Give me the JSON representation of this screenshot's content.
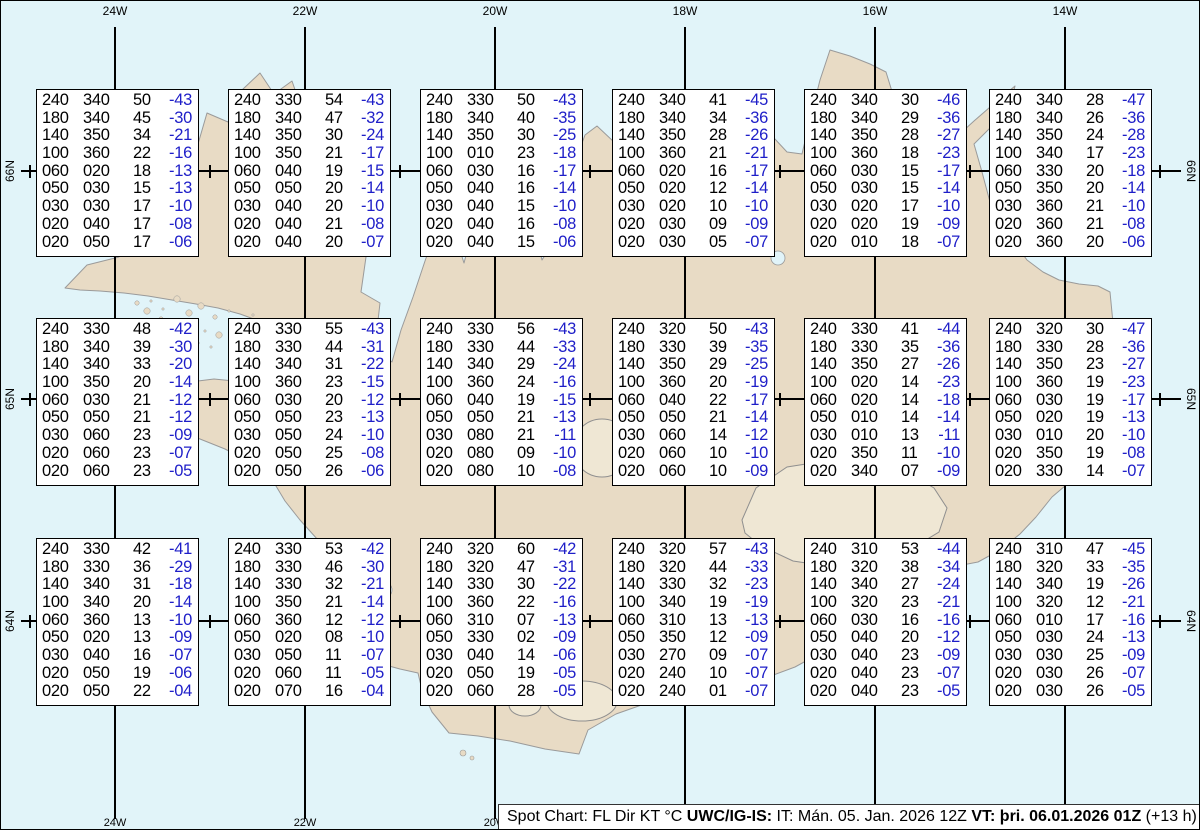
{
  "colors": {
    "sea": "#e1f4f9",
    "land": "#e8dbc5",
    "glacier": "#efe7d4",
    "coast": "#9a9a9a",
    "grid": "#000000",
    "box_bg": "#ffffff",
    "box_border": "#000000",
    "temp_blue": "#1e1ec8"
  },
  "map": {
    "meridian_labels_top": [
      "24W",
      "22W",
      "20W",
      "18W",
      "16W",
      "14W"
    ],
    "meridian_labels_bottom": [
      "24W",
      "22W",
      "20W"
    ],
    "parallel_labels_left": [
      "66N",
      "65N",
      "64N"
    ],
    "parallel_labels_right": [
      "66N",
      "65N",
      "64N"
    ]
  },
  "info_bar": {
    "segments": [
      {
        "text": "Spot Chart: FL Dir KT °C ",
        "bold": false
      },
      {
        "text": "UWC/IG-IS:",
        "bold": true
      },
      {
        "text": " IT: Mán. 05. Jan. 2026 12Z ",
        "bold": false
      },
      {
        "text": "VT: þri. 06.01.2026 01Z",
        "bold": true
      },
      {
        "text": " (+13 h)",
        "bold": false
      }
    ]
  },
  "chart_data": {
    "type": "table",
    "title": "Spot Chart: FL Dir KT °C",
    "issued_label": "IT: Mán. 05. Jan. 2026 12Z",
    "valid_label": "VT: þri. 06.01.2026 01Z (+13 h)",
    "columns": [
      "FL",
      "Dir",
      "KT",
      "°C"
    ],
    "grid_meridians": [
      "24W",
      "22W",
      "20W",
      "18W",
      "16W",
      "14W"
    ],
    "grid_parallels": [
      "66N",
      "65N",
      "64N"
    ],
    "spots": [
      {
        "rows": [
          [
            "240",
            "340",
            "50",
            "-43"
          ],
          [
            "180",
            "340",
            "45",
            "-30"
          ],
          [
            "140",
            "350",
            "34",
            "-21"
          ],
          [
            "100",
            "360",
            "22",
            "-16"
          ],
          [
            "060",
            "020",
            "18",
            "-13"
          ],
          [
            "050",
            "030",
            "15",
            "-13"
          ],
          [
            "030",
            "030",
            "17",
            "-10"
          ],
          [
            "020",
            "040",
            "17",
            "-08"
          ],
          [
            "020",
            "050",
            "17",
            "-06"
          ]
        ]
      },
      {
        "rows": [
          [
            "240",
            "330",
            "54",
            "-43"
          ],
          [
            "180",
            "340",
            "47",
            "-32"
          ],
          [
            "140",
            "350",
            "30",
            "-24"
          ],
          [
            "100",
            "350",
            "21",
            "-17"
          ],
          [
            "060",
            "040",
            "19",
            "-15"
          ],
          [
            "050",
            "050",
            "20",
            "-14"
          ],
          [
            "030",
            "040",
            "20",
            "-10"
          ],
          [
            "020",
            "040",
            "21",
            "-08"
          ],
          [
            "020",
            "040",
            "20",
            "-07"
          ]
        ]
      },
      {
        "rows": [
          [
            "240",
            "330",
            "50",
            "-43"
          ],
          [
            "180",
            "340",
            "40",
            "-35"
          ],
          [
            "140",
            "350",
            "30",
            "-25"
          ],
          [
            "100",
            "010",
            "23",
            "-18"
          ],
          [
            "060",
            "030",
            "16",
            "-17"
          ],
          [
            "050",
            "040",
            "16",
            "-14"
          ],
          [
            "030",
            "040",
            "15",
            "-10"
          ],
          [
            "020",
            "040",
            "16",
            "-08"
          ],
          [
            "020",
            "040",
            "15",
            "-06"
          ]
        ]
      },
      {
        "rows": [
          [
            "240",
            "340",
            "41",
            "-45"
          ],
          [
            "180",
            "340",
            "34",
            "-36"
          ],
          [
            "140",
            "350",
            "28",
            "-26"
          ],
          [
            "100",
            "360",
            "21",
            "-21"
          ],
          [
            "060",
            "020",
            "16",
            "-17"
          ],
          [
            "050",
            "020",
            "12",
            "-14"
          ],
          [
            "030",
            "020",
            "10",
            "-10"
          ],
          [
            "020",
            "030",
            "09",
            "-09"
          ],
          [
            "020",
            "030",
            "05",
            "-07"
          ]
        ]
      },
      {
        "rows": [
          [
            "240",
            "340",
            "30",
            "-46"
          ],
          [
            "180",
            "340",
            "29",
            "-36"
          ],
          [
            "140",
            "350",
            "28",
            "-27"
          ],
          [
            "100",
            "360",
            "18",
            "-23"
          ],
          [
            "060",
            "030",
            "15",
            "-17"
          ],
          [
            "050",
            "030",
            "15",
            "-14"
          ],
          [
            "030",
            "020",
            "17",
            "-10"
          ],
          [
            "020",
            "020",
            "19",
            "-09"
          ],
          [
            "020",
            "010",
            "18",
            "-07"
          ]
        ]
      },
      {
        "rows": [
          [
            "240",
            "340",
            "28",
            "-47"
          ],
          [
            "180",
            "340",
            "26",
            "-36"
          ],
          [
            "140",
            "350",
            "24",
            "-28"
          ],
          [
            "100",
            "340",
            "17",
            "-23"
          ],
          [
            "060",
            "330",
            "20",
            "-18"
          ],
          [
            "050",
            "350",
            "20",
            "-14"
          ],
          [
            "030",
            "360",
            "21",
            "-10"
          ],
          [
            "020",
            "360",
            "21",
            "-08"
          ],
          [
            "020",
            "360",
            "20",
            "-06"
          ]
        ]
      },
      {
        "rows": [
          [
            "240",
            "330",
            "48",
            "-42"
          ],
          [
            "180",
            "340",
            "39",
            "-30"
          ],
          [
            "140",
            "340",
            "33",
            "-20"
          ],
          [
            "100",
            "350",
            "20",
            "-14"
          ],
          [
            "060",
            "030",
            "21",
            "-12"
          ],
          [
            "050",
            "050",
            "21",
            "-12"
          ],
          [
            "030",
            "060",
            "23",
            "-09"
          ],
          [
            "020",
            "060",
            "23",
            "-07"
          ],
          [
            "020",
            "060",
            "23",
            "-05"
          ]
        ]
      },
      {
        "rows": [
          [
            "240",
            "330",
            "55",
            "-43"
          ],
          [
            "180",
            "330",
            "44",
            "-31"
          ],
          [
            "140",
            "340",
            "31",
            "-22"
          ],
          [
            "100",
            "360",
            "23",
            "-15"
          ],
          [
            "060",
            "030",
            "20",
            "-12"
          ],
          [
            "050",
            "050",
            "23",
            "-13"
          ],
          [
            "030",
            "050",
            "24",
            "-10"
          ],
          [
            "020",
            "050",
            "25",
            "-08"
          ],
          [
            "020",
            "050",
            "26",
            "-06"
          ]
        ]
      },
      {
        "rows": [
          [
            "240",
            "330",
            "56",
            "-43"
          ],
          [
            "180",
            "330",
            "44",
            "-33"
          ],
          [
            "140",
            "340",
            "29",
            "-24"
          ],
          [
            "100",
            "360",
            "24",
            "-16"
          ],
          [
            "060",
            "040",
            "19",
            "-15"
          ],
          [
            "050",
            "050",
            "21",
            "-13"
          ],
          [
            "030",
            "080",
            "21",
            "-11"
          ],
          [
            "020",
            "080",
            "09",
            "-10"
          ],
          [
            "020",
            "080",
            "10",
            "-08"
          ]
        ]
      },
      {
        "rows": [
          [
            "240",
            "320",
            "50",
            "-43"
          ],
          [
            "180",
            "330",
            "39",
            "-35"
          ],
          [
            "140",
            "350",
            "29",
            "-25"
          ],
          [
            "100",
            "360",
            "20",
            "-19"
          ],
          [
            "060",
            "040",
            "22",
            "-17"
          ],
          [
            "050",
            "050",
            "21",
            "-14"
          ],
          [
            "030",
            "060",
            "14",
            "-12"
          ],
          [
            "020",
            "060",
            "10",
            "-10"
          ],
          [
            "020",
            "060",
            "10",
            "-09"
          ]
        ]
      },
      {
        "rows": [
          [
            "240",
            "330",
            "41",
            "-44"
          ],
          [
            "180",
            "330",
            "35",
            "-36"
          ],
          [
            "140",
            "350",
            "27",
            "-26"
          ],
          [
            "100",
            "020",
            "14",
            "-23"
          ],
          [
            "060",
            "020",
            "14",
            "-18"
          ],
          [
            "050",
            "010",
            "14",
            "-14"
          ],
          [
            "030",
            "010",
            "13",
            "-11"
          ],
          [
            "020",
            "350",
            "11",
            "-10"
          ],
          [
            "020",
            "340",
            "07",
            "-09"
          ]
        ]
      },
      {
        "rows": [
          [
            "240",
            "320",
            "30",
            "-47"
          ],
          [
            "180",
            "330",
            "28",
            "-36"
          ],
          [
            "140",
            "350",
            "23",
            "-27"
          ],
          [
            "100",
            "360",
            "19",
            "-23"
          ],
          [
            "060",
            "030",
            "19",
            "-17"
          ],
          [
            "050",
            "020",
            "19",
            "-13"
          ],
          [
            "030",
            "010",
            "20",
            "-10"
          ],
          [
            "020",
            "350",
            "19",
            "-08"
          ],
          [
            "020",
            "330",
            "14",
            "-07"
          ]
        ]
      },
      {
        "rows": [
          [
            "240",
            "330",
            "42",
            "-41"
          ],
          [
            "180",
            "330",
            "36",
            "-29"
          ],
          [
            "140",
            "340",
            "31",
            "-18"
          ],
          [
            "100",
            "340",
            "20",
            "-14"
          ],
          [
            "060",
            "360",
            "13",
            "-10"
          ],
          [
            "050",
            "020",
            "13",
            "-09"
          ],
          [
            "030",
            "040",
            "16",
            "-07"
          ],
          [
            "020",
            "050",
            "19",
            "-06"
          ],
          [
            "020",
            "050",
            "22",
            "-04"
          ]
        ]
      },
      {
        "rows": [
          [
            "240",
            "330",
            "53",
            "-42"
          ],
          [
            "180",
            "330",
            "46",
            "-30"
          ],
          [
            "140",
            "330",
            "32",
            "-21"
          ],
          [
            "100",
            "350",
            "21",
            "-14"
          ],
          [
            "060",
            "360",
            "12",
            "-12"
          ],
          [
            "050",
            "020",
            "08",
            "-10"
          ],
          [
            "030",
            "050",
            "11",
            "-07"
          ],
          [
            "020",
            "060",
            "11",
            "-05"
          ],
          [
            "020",
            "070",
            "16",
            "-04"
          ]
        ]
      },
      {
        "rows": [
          [
            "240",
            "320",
            "60",
            "-42"
          ],
          [
            "180",
            "320",
            "47",
            "-31"
          ],
          [
            "140",
            "330",
            "30",
            "-22"
          ],
          [
            "100",
            "360",
            "22",
            "-16"
          ],
          [
            "060",
            "310",
            "07",
            "-13"
          ],
          [
            "050",
            "330",
            "02",
            "-09"
          ],
          [
            "030",
            "040",
            "14",
            "-06"
          ],
          [
            "020",
            "050",
            "19",
            "-05"
          ],
          [
            "020",
            "060",
            "28",
            "-05"
          ]
        ]
      },
      {
        "rows": [
          [
            "240",
            "320",
            "57",
            "-43"
          ],
          [
            "180",
            "320",
            "44",
            "-33"
          ],
          [
            "140",
            "330",
            "32",
            "-23"
          ],
          [
            "100",
            "340",
            "19",
            "-19"
          ],
          [
            "060",
            "310",
            "13",
            "-13"
          ],
          [
            "050",
            "350",
            "12",
            "-09"
          ],
          [
            "030",
            "270",
            "09",
            "-07"
          ],
          [
            "020",
            "240",
            "10",
            "-07"
          ],
          [
            "020",
            "240",
            "01",
            "-07"
          ]
        ]
      },
      {
        "rows": [
          [
            "240",
            "310",
            "53",
            "-44"
          ],
          [
            "180",
            "320",
            "38",
            "-34"
          ],
          [
            "140",
            "340",
            "27",
            "-24"
          ],
          [
            "100",
            "320",
            "23",
            "-21"
          ],
          [
            "060",
            "030",
            "16",
            "-16"
          ],
          [
            "050",
            "040",
            "20",
            "-12"
          ],
          [
            "030",
            "040",
            "23",
            "-09"
          ],
          [
            "020",
            "040",
            "23",
            "-07"
          ],
          [
            "020",
            "040",
            "23",
            "-05"
          ]
        ]
      },
      {
        "rows": [
          [
            "240",
            "310",
            "47",
            "-45"
          ],
          [
            "180",
            "320",
            "33",
            "-35"
          ],
          [
            "140",
            "340",
            "19",
            "-26"
          ],
          [
            "100",
            "320",
            "12",
            "-21"
          ],
          [
            "060",
            "010",
            "17",
            "-16"
          ],
          [
            "050",
            "030",
            "24",
            "-13"
          ],
          [
            "030",
            "030",
            "25",
            "-09"
          ],
          [
            "020",
            "030",
            "26",
            "-07"
          ],
          [
            "020",
            "030",
            "26",
            "-05"
          ]
        ]
      }
    ]
  }
}
